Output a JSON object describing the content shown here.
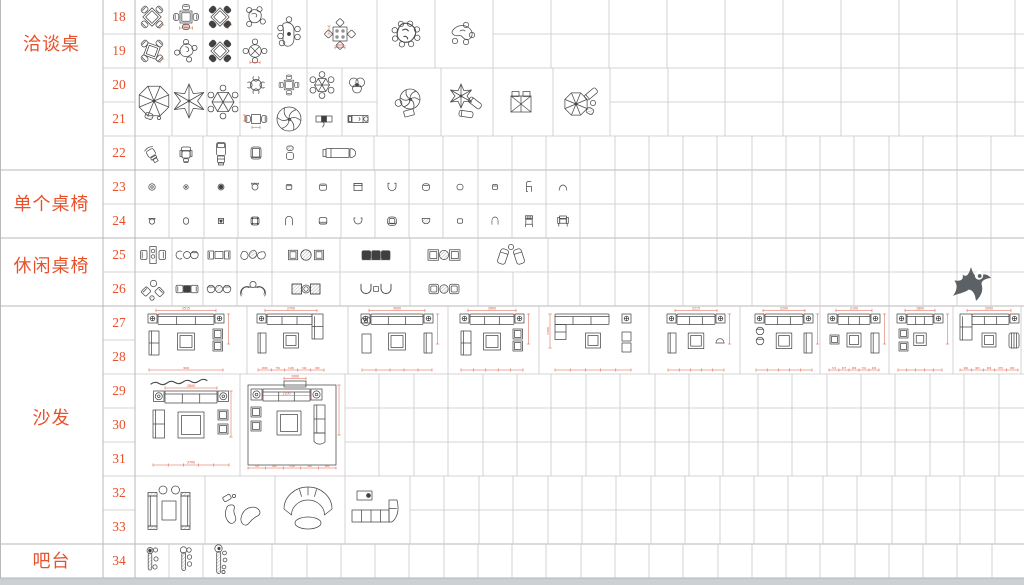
{
  "sheet": {
    "title": "CAD furniture block library sheet",
    "categories": [
      {
        "label": "洽谈桌",
        "row_start": 18,
        "row_end": 22
      },
      {
        "label": "单个桌椅",
        "row_start": 23,
        "row_end": 24
      },
      {
        "label": "休闲桌椅",
        "row_start": 25,
        "row_end": 26
      },
      {
        "label": "沙发",
        "row_start": 27,
        "row_end": 33
      },
      {
        "label": "吧台",
        "row_start": 34,
        "row_end": 34
      }
    ],
    "row_numbers": [
      18,
      19,
      20,
      21,
      22,
      23,
      24,
      25,
      26,
      27,
      28,
      29,
      30,
      31,
      32,
      33,
      34
    ]
  },
  "colors": {
    "accent": "#e8512b",
    "dimension_red": "#d9462a",
    "line": "#4a4a4a",
    "grid": "#c8c8c8",
    "grid_heavy": "#b9b9b9",
    "watermark": "#5c6166",
    "footer_strip": "#cdd0d2"
  },
  "single_chairs": {
    "row23": {
      "y": 187,
      "glyphs": [
        "chair-ring",
        "chair-dot",
        "chair-filled",
        "chair-cup",
        "chair-rsq-small",
        "chair-rsq",
        "chair-square-back",
        "chair-u-shape",
        "chair-rounded",
        "chair-rounded-small",
        "chair-square-xs",
        "chair-side-profile",
        "chair-dome"
      ]
    },
    "row24": {
      "y": 221,
      "glyphs": [
        "chair-cup-small",
        "chair-oval",
        "chair-square-dot",
        "chair-cushion",
        "chair-arch",
        "chair-rsq-base",
        "chair-bowl",
        "chair-armchair-round",
        "chair-bowl-hatch",
        "chair-rsq-xs",
        "chair-arch-small",
        "chair-back-striped",
        "chair-armchair-front"
      ]
    }
  },
  "items": [
    {
      "glyph": "x-table-4-chairs",
      "x": 152,
      "y": 17,
      "opts": {
        "dim": 1
      }
    },
    {
      "glyph": "square-table-4-chairs",
      "x": 186,
      "y": 17,
      "opts": {
        "dim": 1,
        "top": "800"
      }
    },
    {
      "glyph": "x-table-4-chairs",
      "x": 220,
      "y": 17,
      "opts": {
        "dark": 1,
        "dim": 1
      }
    },
    {
      "glyph": "organic-table-4-chairs",
      "x": 255,
      "y": 17,
      "opts": {}
    },
    {
      "glyph": "x-table-4-chairs",
      "x": 152,
      "y": 51,
      "opts": {
        "rot": 20,
        "dim": 1
      }
    },
    {
      "glyph": "organic-table-4-chairs",
      "x": 186,
      "y": 51,
      "opts": {
        "v": 2
      }
    },
    {
      "glyph": "x-table-4-chairs",
      "x": 220,
      "y": 51,
      "opts": {
        "dark": 1
      }
    },
    {
      "glyph": "round-table-4-chairs",
      "x": 255,
      "y": 51,
      "opts": {
        "dim": 1
      }
    },
    {
      "glyph": "oval-table-6-chairs",
      "x": 289,
      "y": 34,
      "opts": {}
    },
    {
      "glyph": "square-table-diamond-chairs",
      "x": 340,
      "y": 34,
      "opts": {
        "top": "800"
      }
    },
    {
      "glyph": "organic-table-8-chairs",
      "x": 406,
      "y": 34,
      "opts": {}
    },
    {
      "glyph": "kidney-table-4-chairs",
      "x": 462,
      "y": 34,
      "opts": {}
    },
    {
      "glyph": "parasol-8-rib",
      "x": 154,
      "y": 101,
      "opts": {
        "r": 16,
        "chair": 1
      }
    },
    {
      "glyph": "parasol-star-6",
      "x": 189,
      "y": 101,
      "opts": {
        "r": 17
      }
    },
    {
      "glyph": "parasol-hex-chairs",
      "x": 223,
      "y": 102,
      "opts": {
        "r": 11
      }
    },
    {
      "glyph": "round-table-4-c-chairs",
      "x": 256,
      "y": 85,
      "opts": {}
    },
    {
      "glyph": "square-table-4-chairs",
      "x": 289,
      "y": 85,
      "opts": {
        "s": 0.8
      }
    },
    {
      "glyph": "parasol-hex-chairs",
      "x": 322,
      "y": 85,
      "opts": {
        "r": 7.5
      }
    },
    {
      "glyph": "table-three-lobe",
      "x": 357,
      "y": 85,
      "opts": {}
    },
    {
      "glyph": "square-table-2-chairs",
      "x": 256,
      "y": 119,
      "opts": {
        "dim": 1
      }
    },
    {
      "glyph": "parasol-pinwheel",
      "x": 289,
      "y": 119,
      "opts": {
        "r": 12
      }
    },
    {
      "glyph": "bench-figure",
      "x": 324,
      "y": 119,
      "opts": {}
    },
    {
      "glyph": "daybed-small",
      "x": 358,
      "y": 119,
      "opts": {}
    },
    {
      "glyph": "parasol-pinwheel-chair",
      "x": 408,
      "y": 102,
      "opts": {}
    },
    {
      "glyph": "parasol-star-loungers",
      "x": 465,
      "y": 101,
      "opts": {}
    },
    {
      "glyph": "double-lounger-canopy",
      "x": 521,
      "y": 102,
      "opts": {}
    },
    {
      "glyph": "parasol-lounge-set",
      "x": 580,
      "y": 102,
      "opts": {}
    },
    {
      "glyph": "office-chair-angled",
      "x": 151,
      "y": 153,
      "opts": {}
    },
    {
      "glyph": "office-chair-front",
      "x": 186,
      "y": 153,
      "opts": {}
    },
    {
      "glyph": "recliner-vertical",
      "x": 221,
      "y": 153,
      "opts": {}
    },
    {
      "glyph": "club-chair",
      "x": 256,
      "y": 153,
      "opts": {}
    },
    {
      "glyph": "chair-two-piece",
      "x": 290,
      "y": 153,
      "opts": {}
    },
    {
      "glyph": "daybed-wide",
      "x": 340,
      "y": 153,
      "opts": {}
    },
    {
      "glyph": "lounge-set-compact",
      "x": 153,
      "y": 255,
      "opts": {}
    },
    {
      "glyph": "lounge-set-three-round",
      "x": 187,
      "y": 255,
      "opts": {}
    },
    {
      "glyph": "lounge-set-chairs-square",
      "x": 219,
      "y": 255,
      "opts": {}
    },
    {
      "glyph": "lounge-set-three-blobs",
      "x": 253,
      "y": 255,
      "opts": {}
    },
    {
      "glyph": "lounge-set-hatch-round-wide",
      "x": 306,
      "y": 255,
      "opts": {}
    },
    {
      "glyph": "lounge-set-bench-dark",
      "x": 376,
      "y": 255,
      "opts": {}
    },
    {
      "glyph": "lounge-set-square-hatch",
      "x": 444,
      "y": 255,
      "opts": {}
    },
    {
      "glyph": "lounge-set-recliners",
      "x": 511,
      "y": 255,
      "opts": {}
    },
    {
      "glyph": "lounge-set-angled-chairs",
      "x": 153,
      "y": 289,
      "opts": {}
    },
    {
      "glyph": "lounge-set-dark-square",
      "x": 187,
      "y": 289,
      "opts": {}
    },
    {
      "glyph": "lounge-set-round-hatch",
      "x": 219,
      "y": 289,
      "opts": {}
    },
    {
      "glyph": "lounge-set-curved-chairs",
      "x": 253,
      "y": 289,
      "opts": {}
    },
    {
      "glyph": "lounge-set-hatch-squares",
      "x": 306,
      "y": 289,
      "opts": {}
    },
    {
      "glyph": "lounge-set-u-chairs",
      "x": 376,
      "y": 289,
      "opts": {}
    },
    {
      "glyph": "lounge-set-cushion-hatch",
      "x": 444,
      "y": 289,
      "opts": {}
    },
    {
      "glyph": "sofa-set",
      "x": 186,
      "y": 340,
      "opts": {
        "kind": "sym",
        "w": 78,
        "top": "2515",
        "bottom": "3000",
        "lt": "love",
        "rt": "cab"
      }
    },
    {
      "glyph": "sofa-set",
      "x": 291,
      "y": 340,
      "opts": {
        "kind": "L",
        "w": 70,
        "top": "2700",
        "bottom": "1650 750 1100 340 900",
        "lt": "console"
      }
    },
    {
      "glyph": "sofa-set",
      "x": 397,
      "y": 340,
      "opts": {
        "kind": "sym",
        "w": 74,
        "top": "3000",
        "lt": "round",
        "rt": "console"
      }
    },
    {
      "glyph": "sofa-set",
      "x": 492,
      "y": 340,
      "opts": {
        "kind": "sym",
        "w": 66,
        "top": "2600",
        "lt": "love",
        "rt": "cab"
      }
    },
    {
      "glyph": "sofa-set",
      "x": 593,
      "y": 340,
      "opts": {
        "kind": "L2",
        "w": 80,
        "left": "3300",
        "rt": "stools2"
      }
    },
    {
      "glyph": "sofa-set",
      "x": 696,
      "y": 340,
      "opts": {
        "kind": "sym",
        "w": 60,
        "top": "2215",
        "lt": "console",
        "rt": "roundch"
      }
    },
    {
      "glyph": "sofa-set",
      "x": 784,
      "y": 340,
      "opts": {
        "kind": "sym",
        "w": 60,
        "top": "2200",
        "lt": "roundch2",
        "rt": "console"
      }
    },
    {
      "glyph": "sofa-set",
      "x": 854,
      "y": 340,
      "opts": {
        "kind": "sym",
        "w": 54,
        "top": "2100",
        "lt": "stool",
        "rt": "console",
        "bottom": "721 677 900 791 200"
      }
    },
    {
      "glyph": "sofa-set",
      "x": 920,
      "y": 340,
      "opts": {
        "kind": "sym",
        "w": 48,
        "top": "1800",
        "lt": "stools2",
        "rt": "none"
      }
    },
    {
      "glyph": "sofa-set",
      "x": 989,
      "y": 340,
      "opts": {
        "kind": "Lr",
        "w": 62,
        "top": "2000",
        "bottom": "900 963 900 878 900"
      }
    },
    {
      "glyph": "sofa-set-large-a",
      "x": 191,
      "y": 425,
      "opts": {
        "top": "2800",
        "bottom": "3700"
      }
    },
    {
      "glyph": "sofa-set-large-b",
      "x": 292,
      "y": 425,
      "opts": {
        "top": "2200",
        "inner": "1000",
        "bottom": "720 900 1200 900 800"
      }
    },
    {
      "glyph": "sofa-pair-table-set",
      "x": 169,
      "y": 510,
      "opts": {}
    },
    {
      "glyph": "sofa-bean-set",
      "x": 240,
      "y": 510,
      "opts": {}
    },
    {
      "glyph": "sofa-curved-arc",
      "x": 308,
      "y": 510,
      "opts": {}
    },
    {
      "glyph": "sofa-modular-l",
      "x": 377,
      "y": 509,
      "opts": {}
    },
    {
      "glyph": "bar-counter-stools",
      "x": 150,
      "y": 561,
      "opts": {
        "v": 1
      }
    },
    {
      "glyph": "bar-counter-stools",
      "x": 184,
      "y": 561,
      "opts": {
        "v": 2
      }
    },
    {
      "glyph": "bar-counter-stools",
      "x": 219,
      "y": 561,
      "opts": {
        "v": 3
      }
    },
    {
      "glyph": "logo-watermark",
      "x": 971,
      "y": 283,
      "opts": {}
    }
  ]
}
